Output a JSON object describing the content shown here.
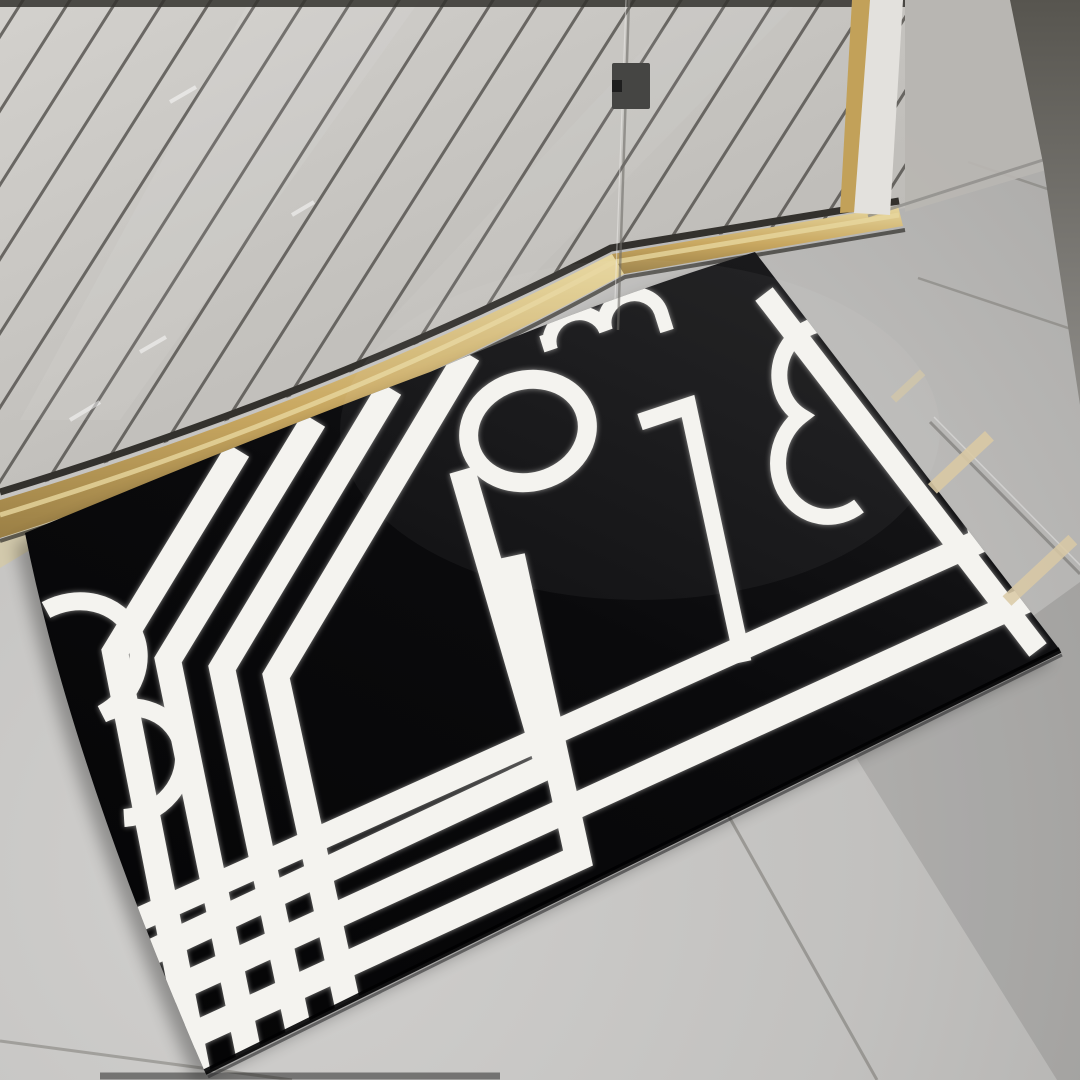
{
  "scene": {
    "description_label": "bathroom-bath-mat-photo",
    "objects": [
      "shower-slatted-floor",
      "glass-shower-door",
      "gold-threshold",
      "door-frame-post",
      "bathroom-wall",
      "grey-tile-floor",
      "black-white-geometric-bath-mat"
    ],
    "colors": {
      "floor": "#c2c1bf",
      "floor_light": "#d1d0ce",
      "floor_shade": "#aaa9a7",
      "slat": "#c9c7c3",
      "slat_line": "#504e4a",
      "slat_edge": "#33312d",
      "gold": "#c9a861",
      "gold_pale": "#e7d79f",
      "gold_deep": "#9a7f45",
      "gold_shadow": "#2e2c28",
      "wall": "#b9b7b3",
      "wall_base": "#8f8d89",
      "wall_dark": "#57554f",
      "post_white": "#e3e1dd",
      "post_gold": "#c2a159",
      "glass_line": "#6e6c68",
      "glass_refl": "#d9c9a4",
      "hinge": "#454543",
      "cord": "#efeeec",
      "mat_black": "#0a0a0c",
      "pattern_white": "#f4f3ef",
      "grout": "#77756f",
      "shadow": "#000000"
    }
  }
}
